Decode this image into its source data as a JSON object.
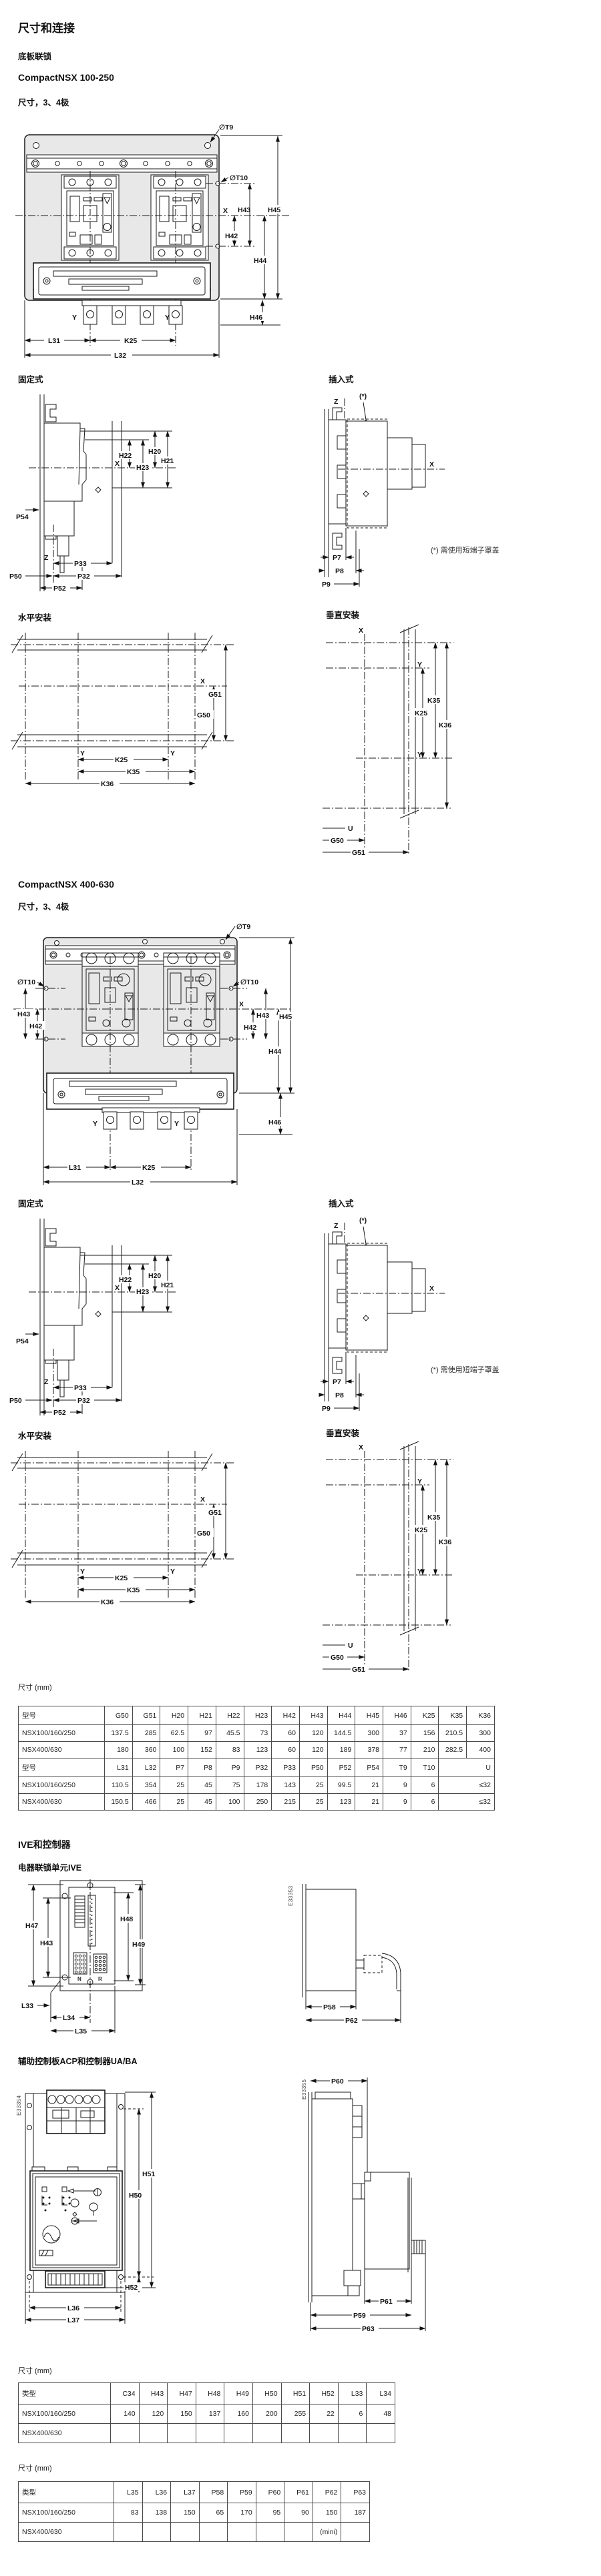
{
  "page": {
    "title": "尺寸和连接",
    "section1": "底板联锁",
    "product1": "CompactNSX 100-250",
    "product2": "CompactNSX 400-630",
    "poles_label": "尺寸，3、4极",
    "fixed_label": "固定式",
    "plugin_label": "插入式",
    "horizontal_label": "水平安装",
    "vertical_label": "垂直安装",
    "plugin_note": "(*) 需使用短端子罩盖",
    "ive_section": "IVE和控制器",
    "ive_title": "电器联锁单元IVE",
    "acp_title": "辅助控制板ACP和控制器UA/BA"
  },
  "dims": {
    "t9": "∅T9",
    "t10": "∅T10",
    "h20": "H20",
    "h21": "H21",
    "h22": "H22",
    "h23": "H23",
    "h42": "H42",
    "h43": "H43",
    "h44": "H44",
    "h45": "H45",
    "h46": "H46",
    "h47": "H47",
    "h48": "H48",
    "h49": "H49",
    "h50": "H50",
    "h51": "H51",
    "h52": "H52",
    "g50": "G50",
    "g51": "G51",
    "k25": "K25",
    "k35": "K35",
    "k36": "K36",
    "l31": "L31",
    "l32": "L32",
    "l33": "L33",
    "l34": "L34",
    "l35": "L35",
    "l36": "L36",
    "l37": "L37",
    "p7": "P7",
    "p8": "P8",
    "p9": "P9",
    "p32": "P32",
    "p33": "P33",
    "p50": "P50",
    "p52": "P52",
    "p54": "P54",
    "p58": "P58",
    "p59": "P59",
    "p60": "P60",
    "p61": "P61",
    "p62": "P62",
    "p63": "P63",
    "x": "X",
    "y": "Y",
    "z": "Z",
    "u": "U",
    "star": "(*)",
    "n": "N",
    "r": "R"
  },
  "figure_refs": {
    "ive": "E33353",
    "acp_front": "E33354",
    "acp_side": "E33355"
  },
  "dim_table": {
    "caption": "尺寸 (mm)",
    "rows": [
      {
        "header": true,
        "cells": [
          "型号",
          "G50",
          "G51",
          "H20",
          "H21",
          "H22",
          "H23",
          "H42",
          "H43",
          "H44",
          "H45",
          "H46",
          "K25",
          "K35",
          "K36"
        ]
      },
      {
        "header": false,
        "cells": [
          "NSX100/160/250",
          "137.5",
          "285",
          "62.5",
          "97",
          "45.5",
          "73",
          "60",
          "120",
          "144.5",
          "300",
          "37",
          "156",
          "210.5",
          "300"
        ]
      },
      {
        "header": false,
        "cells": [
          "NSX400/630",
          "180",
          "360",
          "100",
          "152",
          "83",
          "123",
          "60",
          "120",
          "189",
          "378",
          "77",
          "210",
          "282.5",
          "400"
        ]
      },
      {
        "header": true,
        "cells": [
          "型号",
          "L31",
          "L32",
          "P7",
          "P8",
          "P9",
          "P32",
          "P33",
          "P50",
          "P52",
          "P54",
          "T9",
          "T10",
          "U"
        ]
      },
      {
        "header": false,
        "cells": [
          "NSX100/160/250",
          "110.5",
          "354",
          "25",
          "45",
          "75",
          "178",
          "143",
          "25",
          "99.5",
          "21",
          "9",
          "6",
          "≤32"
        ]
      },
      {
        "header": false,
        "cells": [
          "NSX400/630",
          "150.5",
          "466",
          "25",
          "45",
          "100",
          "250",
          "215",
          "25",
          "123",
          "21",
          "9",
          "6",
          "≤32"
        ]
      }
    ]
  },
  "acp_table1": {
    "caption": "尺寸 (mm)",
    "rows": [
      {
        "header": true,
        "cells": [
          "类型",
          "C34",
          "H43",
          "H47",
          "H48",
          "H49",
          "H50",
          "H51",
          "H52",
          "L33",
          "L34"
        ]
      },
      {
        "header": false,
        "cells": [
          "NSX100/160/250",
          "140",
          "120",
          "150",
          "137",
          "160",
          "200",
          "255",
          "22",
          "6",
          "48"
        ]
      },
      {
        "header": false,
        "cells": [
          "NSX400/630",
          "",
          "",
          "",
          "",
          "",
          "",
          "",
          "",
          "",
          ""
        ]
      }
    ]
  },
  "acp_table2": {
    "caption": "尺寸 (mm)",
    "rows": [
      {
        "header": true,
        "cells": [
          "类型",
          "L35",
          "L36",
          "L37",
          "P58",
          "P59",
          "P60",
          "P61",
          "P62",
          "P63"
        ]
      },
      {
        "header": false,
        "cells": [
          "NSX100/160/250",
          "83",
          "138",
          "150",
          "65",
          "170",
          "95",
          "90",
          "150",
          "187"
        ]
      },
      {
        "header": false,
        "cells": [
          "NSX400/630",
          "",
          "",
          "",
          "",
          "",
          "",
          "",
          "(mini)",
          ""
        ]
      }
    ]
  }
}
